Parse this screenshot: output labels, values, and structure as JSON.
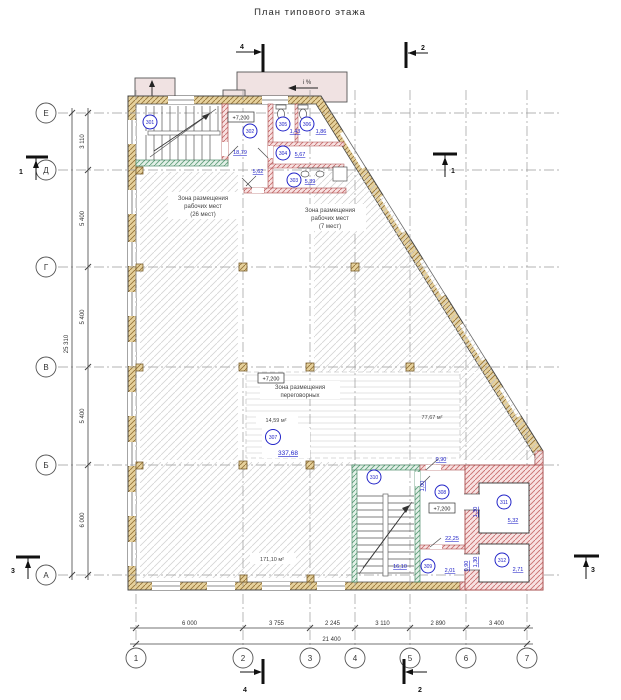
{
  "title": "План типового этажа",
  "grid": {
    "cols": [
      "1",
      "2",
      "3",
      "4",
      "5",
      "6",
      "7"
    ],
    "rows": [
      "Е",
      "Д",
      "Г",
      "В",
      "Б",
      "А"
    ]
  },
  "dims": {
    "bottom": [
      "6 000",
      "3 755",
      "2 245",
      "3 110",
      "2 890",
      "3 400"
    ],
    "bottom_total": "21 400",
    "left": [
      "3 110",
      "5 400",
      "5 400",
      "5 400",
      "6 000"
    ],
    "left_total": "25 310"
  },
  "levels": {
    "upper": "+7,200",
    "middle": "+7,200",
    "lower": "+7,200"
  },
  "zones": {
    "work26": {
      "l1": "Зона размещения",
      "l2": "рабочих мест",
      "l3": "(26 мест)"
    },
    "work7": {
      "l1": "Зона размещения",
      "l2": "рабочих мест",
      "l3": "(7 мест)"
    },
    "meeting": {
      "l1": "Зона размещения",
      "l2": "переговорных"
    }
  },
  "areas": {
    "meeting_left": "14,59 м²",
    "right_zone": "77,67 м²",
    "bottom_left": "171,10 м²",
    "corridor": "5,62"
  },
  "rooms": {
    "r301": {
      "number": "301"
    },
    "r302": {
      "number": "302",
      "area": "18,79"
    },
    "r303": {
      "number": "303",
      "area": "5,39"
    },
    "r304": {
      "number": "304",
      "area": "5,67"
    },
    "r305": {
      "number": "305",
      "area": "1,43"
    },
    "r306": {
      "number": "306",
      "area": "1,86"
    },
    "r307": {
      "number": "307",
      "area": "337,68"
    },
    "r308": {
      "number": "308",
      "area": "22,25"
    },
    "r309": {
      "number": "309",
      "area": "2,01"
    },
    "r310": {
      "number": "310",
      "area": "16,10"
    },
    "r311": {
      "number": "311",
      "area": "5,32"
    },
    "r312": {
      "number": "312",
      "area": "2,71"
    }
  },
  "small_dims": {
    "door_top": "0,90",
    "stair_door": "1,00",
    "lift1": "1,30",
    "lift2": "1,30",
    "door_309": "0,90"
  },
  "sections": {
    "s1": "1",
    "s2": "2",
    "s3": "3",
    "s4": "4"
  },
  "slope_label": "i %",
  "colors": {
    "annotation_blue": "#2224c8",
    "wall_masonry_tan": "#e6d19c",
    "wall_partition_pink": "#f8e2e2",
    "wall_partition_green": "#e3f0e8"
  }
}
